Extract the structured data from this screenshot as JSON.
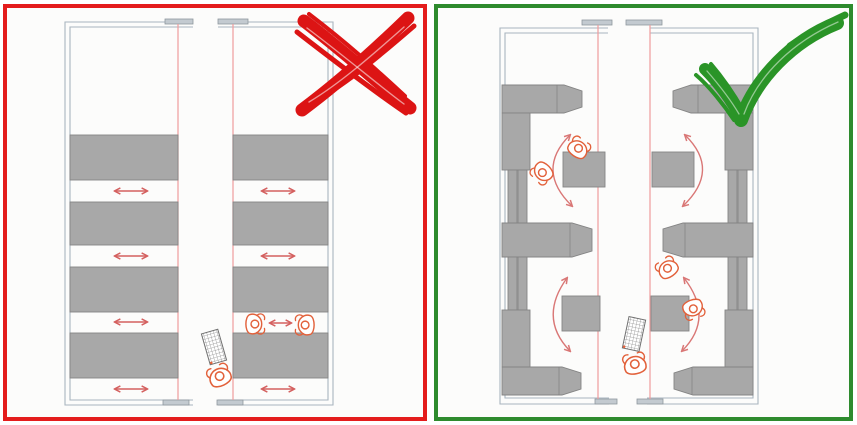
{
  "meta": {
    "title": "Floor-plan comparison: two-way aisles crossed out versus one-way circulation around shelving approved",
    "type": "floor-plan comparison diagram",
    "text_content": "none (purely graphical diagram)"
  },
  "colors": {
    "wrong_border": "#e41c1c",
    "correct_border": "#2e8b2e",
    "x_mark": "#dc1414",
    "check_mark": "#2a9427",
    "wall": "#a9b5bf",
    "door_fill": "#c3cad0",
    "door_stroke": "#8e969d",
    "shelf_fill": "#a8a8a8",
    "shelf_stroke": "#848484",
    "route_line": "#ef9d9d",
    "arrow": "#d4605f",
    "person": "#e2613b",
    "cart_stroke": "#707070",
    "panel_bg": "#fcfcfb"
  },
  "left_panel": {
    "verdict": "incorrect",
    "symbol": "x-mark",
    "rooms": [
      {
        "name": "left-room",
        "stacks": 4,
        "aisles_with_two_way_arrows": 4,
        "people": 0
      },
      {
        "name": "right-room",
        "stacks": 4,
        "aisles_with_two_way_arrows": 4,
        "people": 2,
        "people_note": "two figures face each other in one aisle with a two-way arrow between them"
      }
    ],
    "corridor": {
      "people": 1,
      "book_trolley": true
    },
    "route_lines": 2
  },
  "right_panel": {
    "verdict": "correct",
    "symbol": "check-mark",
    "rooms": [
      {
        "name": "left-room",
        "wall_shelf_units": 7,
        "pointed_end_shelves": 3,
        "island_shelves": 2,
        "one_way_arcs": 2,
        "people": 2
      },
      {
        "name": "right-room",
        "wall_shelf_units": 7,
        "pointed_end_shelves": 3,
        "island_shelves": 2,
        "one_way_arcs": 2,
        "people": 2
      }
    ],
    "corridor": {
      "people": 1,
      "book_trolley": true
    },
    "route_lines": 2
  }
}
